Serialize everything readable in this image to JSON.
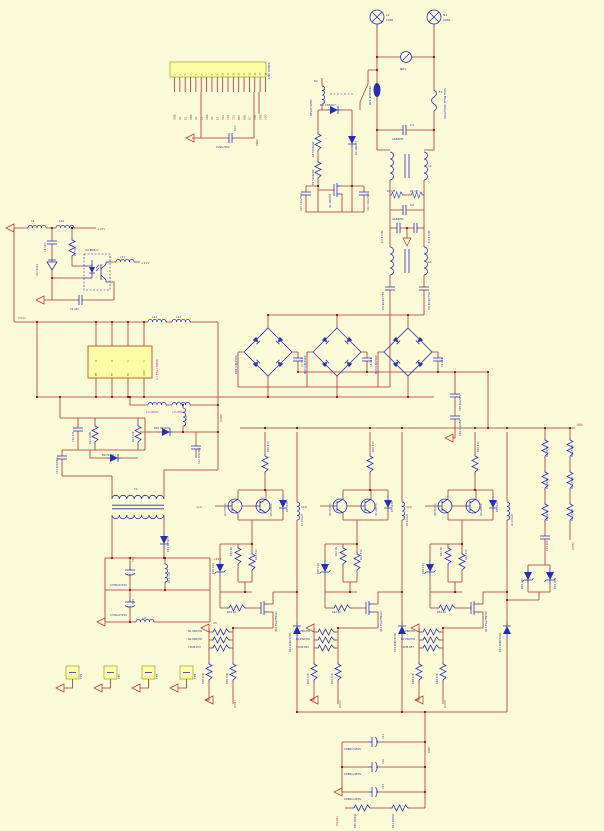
{
  "canvas": {
    "width": 604,
    "height": 831
  },
  "colors": {
    "background": "#fbfbd7",
    "wire": "#b03030",
    "component": "#2b2bb4",
    "junction": "#7d1414",
    "panel_fill": "#ffffa8",
    "panel_stroke": "#a8a832",
    "ic_stroke": "#c24a30",
    "text": {
      "b": "#2b2bb4",
      "r": "#b03030",
      "m": "#bb33bb",
      "k": "#6b6b2a"
    }
  },
  "connector": {
    "ref": "CN1 CON18",
    "pins": [
      "GND",
      "G1",
      "E1",
      "GND",
      "G2",
      "E2",
      "GND",
      "G3",
      "E3",
      "CS1",
      "CS2",
      "CS3",
      "NTC",
      "FAN",
      "SC",
      "VFB",
      "GND",
      "VDD"
    ]
  },
  "ic": {
    "ref": "U1 FSL136MR",
    "pins_top": [
      "D",
      "D",
      "S",
      "S"
    ],
    "pins_bottom": [
      "BP",
      "FB",
      "EN",
      "GND"
    ]
  },
  "testpoints": [
    "TP1",
    "TP2",
    "TP3",
    "TP4"
  ],
  "labels": [
    {
      "t": "C22u/50V",
      "x": 216,
      "y": 148,
      "s": 2.8
    },
    {
      "t": "C17",
      "x": 236,
      "y": 131,
      "r": -90,
      "s": 2.8
    },
    {
      "t": "VDD",
      "x": 258,
      "y": 146,
      "r": -90,
      "c": "r",
      "s": 3
    },
    {
      "t": "L1",
      "x": 386,
      "y": 16,
      "s": 3
    },
    {
      "t": "CON1",
      "x": 386,
      "y": 21,
      "s": 2.6
    },
    {
      "t": "N1",
      "x": 443,
      "y": 16,
      "s": 3
    },
    {
      "t": "CON1",
      "x": 443,
      "y": 21,
      "s": 2.6
    },
    {
      "t": "NE1",
      "x": 400,
      "y": 70,
      "s": 3
    },
    {
      "t": "RV1 10D561K",
      "x": 371,
      "y": 105,
      "r": -90,
      "s": 2.8
    },
    {
      "t": "F1",
      "x": 439,
      "y": 93,
      "s": 3
    },
    {
      "t": "Slow Blow 40A/250V",
      "x": 444,
      "y": 88,
      "r": 90,
      "s": 3
    },
    {
      "t": "K1",
      "x": 314,
      "y": 82,
      "s": 3
    },
    {
      "t": "RELAY-SPDT",
      "x": 312,
      "y": 116,
      "r": -90,
      "s": 2.8
    },
    {
      "t": "C1",
      "x": 410,
      "y": 126,
      "s": 3
    },
    {
      "t": "A682PM",
      "x": 392,
      "y": 140,
      "s": 2.8
    },
    {
      "t": "L2",
      "x": 428,
      "y": 167,
      "s": 3
    },
    {
      "t": "R1 1M",
      "x": 387,
      "y": 192,
      "s": 2.5
    },
    {
      "t": "R2 1M",
      "x": 410,
      "y": 192,
      "s": 2.5
    },
    {
      "t": "C2",
      "x": 410,
      "y": 206,
      "s": 3
    },
    {
      "t": "A682PM",
      "x": 392,
      "y": 220,
      "s": 2.8
    },
    {
      "t": "C3 472M",
      "x": 383,
      "y": 243,
      "r": -90,
      "s": 2.8
    },
    {
      "t": "C4 472M",
      "x": 430,
      "y": 243,
      "r": -90,
      "s": 2.8
    },
    {
      "t": "L3",
      "x": 428,
      "y": 263,
      "s": 3
    },
    {
      "t": "C5 104/275V",
      "x": 384,
      "y": 310,
      "r": -90,
      "s": 2.8
    },
    {
      "t": "C6 104/275V",
      "x": 430,
      "y": 310,
      "r": -90,
      "s": 2.8
    },
    {
      "t": "D1 1N4007",
      "x": 320,
      "y": 106,
      "s": 2.8
    },
    {
      "t": "R5 510K/2W",
      "x": 314,
      "y": 157,
      "r": -90,
      "s": 2.5
    },
    {
      "t": "R6 510K/2W",
      "x": 314,
      "y": 185,
      "r": -90,
      "s": 2.5
    },
    {
      "t": "D2 1N4007",
      "x": 357,
      "y": 155,
      "r": -90,
      "s": 2.5
    },
    {
      "t": "Q1 2N7002",
      "x": 331,
      "y": 208,
      "r": -90,
      "s": 2.5
    },
    {
      "t": "C15 C10u/50V",
      "x": 302,
      "y": 211,
      "r": -90,
      "s": 2.5
    },
    {
      "t": "C16 C10u/50V",
      "x": 369,
      "y": 211,
      "r": -90,
      "s": 2.5
    },
    {
      "t": "BR1 GBJ2510",
      "x": 237,
      "y": 374,
      "r": -90,
      "s": 2.8
    },
    {
      "t": "BR2 GBJ2510",
      "x": 306,
      "y": 374,
      "r": -90,
      "s": 2.8
    },
    {
      "t": "BR3 GBJ2510",
      "x": 377,
      "y": 374,
      "r": -90,
      "s": 2.8
    },
    {
      "t": "C7 471",
      "x": 303,
      "y": 367,
      "r": -90,
      "s": 2.5
    },
    {
      "t": "C8 471",
      "x": 372,
      "y": 367,
      "r": -90,
      "s": 2.5
    },
    {
      "t": "C9 471",
      "x": 443,
      "y": 367,
      "r": -90,
      "s": 2.5
    },
    {
      "t": "C18 102/2KV",
      "x": 461,
      "y": 411,
      "r": -90,
      "s": 2.5
    },
    {
      "t": "C19 102/2KV",
      "x": 461,
      "y": 436,
      "r": -90,
      "s": 2.5
    },
    {
      "t": "VIN",
      "x": 577,
      "y": 426,
      "c": "r",
      "s": 3.2
    },
    {
      "t": "(VDD)",
      "x": 222,
      "y": 422,
      "r": -90,
      "c": "r",
      "s": 2.8
    },
    {
      "t": "(VCC)",
      "x": 18,
      "y": 319,
      "c": "r",
      "s": 2.8
    },
    {
      "t": "R3 510K",
      "x": 548,
      "y": 457,
      "r": -90,
      "s": 2.5
    },
    {
      "t": "R4 510K",
      "x": 548,
      "y": 489,
      "r": -90,
      "s": 2.5
    },
    {
      "t": "R7 510K",
      "x": 548,
      "y": 521,
      "r": -90,
      "s": 2.5
    },
    {
      "t": "C31 104",
      "x": 548,
      "y": 551,
      "r": -90,
      "s": 2.5
    },
    {
      "t": "R15 510K",
      "x": 573,
      "y": 457,
      "r": -90,
      "s": 2.5
    },
    {
      "t": "R16 510K",
      "x": 573,
      "y": 489,
      "r": -90,
      "s": 2.5
    },
    {
      "t": "R17 510K",
      "x": 573,
      "y": 521,
      "r": -90,
      "s": 2.5
    },
    {
      "t": "(VFB)",
      "x": 574,
      "y": 550,
      "r": -90,
      "c": "r",
      "s": 2.8
    },
    {
      "t": "DZ1 30V",
      "x": 523,
      "y": 589,
      "r": -90,
      "s": 2.5
    },
    {
      "t": "DZ2 30V",
      "x": 556,
      "y": 589,
      "r": -90,
      "s": 2.5
    },
    {
      "t": "R30 510",
      "x": 269,
      "y": 452,
      "r": -90,
      "s": 2.5
    },
    {
      "t": "(G1)",
      "x": 196,
      "y": 508,
      "c": "r",
      "s": 2.8
    },
    {
      "t": "Q4 C8050",
      "x": 226,
      "y": 516,
      "r": -90,
      "s": 2.5
    },
    {
      "t": "Q5 A8550",
      "x": 272,
      "y": 516,
      "r": -90,
      "s": 2.5
    },
    {
      "t": "D4 4148",
      "x": 288,
      "y": 512,
      "r": -90,
      "s": 2.5
    },
    {
      "t": "R32 1K",
      "x": 232,
      "y": 556,
      "r": -90,
      "s": 2.5
    },
    {
      "t": "R33 510",
      "x": 257,
      "y": 560,
      "r": -90,
      "s": 2.5
    },
    {
      "t": "DZ4 12V",
      "x": 214,
      "y": 574,
      "r": -90,
      "s": 2.5
    },
    {
      "t": "L4 100uH",
      "x": 303,
      "y": 526,
      "r": -90,
      "s": 2.5
    },
    {
      "t": "R34 10",
      "x": 227,
      "y": 613,
      "s": 2.5
    },
    {
      "t": "Q10 FGA25N120",
      "x": 277,
      "y": 632,
      "r": -90,
      "s": 2.5
    },
    {
      "t": "N1-P80/3W",
      "x": 188,
      "y": 632,
      "s": 2.5
    },
    {
      "t": "N2-P80/3W",
      "x": 188,
      "y": 640,
      "s": 2.5
    },
    {
      "t": "Y1K/B R37",
      "x": 188,
      "y": 648,
      "s": 2.5
    },
    {
      "t": "R38 47K",
      "x": 204,
      "y": 684,
      "r": -90,
      "s": 2.5
    },
    {
      "t": "R39 47K",
      "x": 228,
      "y": 684,
      "r": -90,
      "s": 2.5
    },
    {
      "t": "D12 RHRP3060",
      "x": 291,
      "y": 652,
      "r": -90,
      "s": 2.5
    },
    {
      "t": "(CS1)",
      "x": 236,
      "y": 708,
      "r": -90,
      "c": "r",
      "s": 2.8
    },
    {
      "t": "R40 510",
      "x": 374,
      "y": 452,
      "r": -90,
      "s": 2.5
    },
    {
      "t": "(G2)",
      "x": 301,
      "y": 508,
      "c": "r",
      "s": 2.8
    },
    {
      "t": "Q6 C8050",
      "x": 331,
      "y": 516,
      "r": -90,
      "s": 2.5
    },
    {
      "t": "Q7 A8550",
      "x": 377,
      "y": 516,
      "r": -90,
      "s": 2.5
    },
    {
      "t": "D5 4148",
      "x": 393,
      "y": 512,
      "r": -90,
      "s": 2.5
    },
    {
      "t": "R42 1K",
      "x": 337,
      "y": 556,
      "r": -90,
      "s": 2.5
    },
    {
      "t": "R43 510",
      "x": 362,
      "y": 560,
      "r": -90,
      "s": 2.5
    },
    {
      "t": "DZ5 12V",
      "x": 319,
      "y": 574,
      "r": -90,
      "s": 2.5
    },
    {
      "t": "L5 100uH",
      "x": 408,
      "y": 526,
      "r": -90,
      "s": 2.5
    },
    {
      "t": "R44 10",
      "x": 332,
      "y": 613,
      "s": 2.5
    },
    {
      "t": "Q11 FGA25N120",
      "x": 382,
      "y": 632,
      "r": -90,
      "s": 2.5
    },
    {
      "t": "N1-P80/3W",
      "x": 296,
      "y": 632,
      "s": 2.5
    },
    {
      "t": "N2-P80/3W",
      "x": 296,
      "y": 640,
      "s": 2.5
    },
    {
      "t": "Y1K/B R47",
      "x": 296,
      "y": 648,
      "s": 2.5
    },
    {
      "t": "R48 47K",
      "x": 309,
      "y": 684,
      "r": -90,
      "s": 2.5
    },
    {
      "t": "R49 47K",
      "x": 333,
      "y": 684,
      "r": -90,
      "s": 2.5
    },
    {
      "t": "D13 RHRP3060",
      "x": 396,
      "y": 652,
      "r": -90,
      "s": 2.5
    },
    {
      "t": "(CS2)",
      "x": 341,
      "y": 708,
      "r": -90,
      "c": "r",
      "s": 2.8
    },
    {
      "t": "R50 510",
      "x": 479,
      "y": 452,
      "r": -90,
      "s": 2.5
    },
    {
      "t": "(G3)",
      "x": 406,
      "y": 508,
      "c": "r",
      "s": 2.8
    },
    {
      "t": "Q8 C8050",
      "x": 436,
      "y": 516,
      "r": -90,
      "s": 2.5
    },
    {
      "t": "Q9 A8550",
      "x": 482,
      "y": 516,
      "r": -90,
      "s": 2.5
    },
    {
      "t": "D6 4148",
      "x": 498,
      "y": 512,
      "r": -90,
      "s": 2.5
    },
    {
      "t": "R52 1K",
      "x": 442,
      "y": 556,
      "r": -90,
      "s": 2.5
    },
    {
      "t": "R53 510",
      "x": 467,
      "y": 560,
      "r": -90,
      "s": 2.5
    },
    {
      "t": "DZ6 12V",
      "x": 424,
      "y": 574,
      "r": -90,
      "s": 2.5
    },
    {
      "t": "L6 100uH",
      "x": 513,
      "y": 526,
      "r": -90,
      "s": 2.5
    },
    {
      "t": "R54 10",
      "x": 437,
      "y": 613,
      "s": 2.5
    },
    {
      "t": "Q12 FGA25N120",
      "x": 487,
      "y": 632,
      "r": -90,
      "s": 2.5
    },
    {
      "t": "N1-P80/3W",
      "x": 401,
      "y": 632,
      "s": 2.5
    },
    {
      "t": "N2-P80/3W",
      "x": 401,
      "y": 640,
      "s": 2.5
    },
    {
      "t": "Y1K/B R57",
      "x": 401,
      "y": 648,
      "s": 2.5
    },
    {
      "t": "R58 47K",
      "x": 414,
      "y": 684,
      "r": -90,
      "s": 2.5
    },
    {
      "t": "R59 47K",
      "x": 438,
      "y": 684,
      "r": -90,
      "s": 2.5
    },
    {
      "t": "D14 RHRP3060",
      "x": 501,
      "y": 652,
      "r": -90,
      "s": 2.5
    },
    {
      "t": "(CS3)",
      "x": 446,
      "y": 708,
      "r": -90,
      "c": "r",
      "s": 2.8
    },
    {
      "t": "L9",
      "x": 31,
      "y": 222,
      "s": 2.8
    },
    {
      "t": "L10",
      "x": 59,
      "y": 222,
      "s": 2.8
    },
    {
      "t": "+15V",
      "x": 97,
      "y": 230,
      "c": "r",
      "s": 3
    },
    {
      "t": "C8 104",
      "x": 46,
      "y": 252,
      "r": -90,
      "s": 2.5
    },
    {
      "t": "R9 51K",
      "x": 76,
      "y": 256,
      "r": -90,
      "s": 2.5
    },
    {
      "t": "U3 TL431",
      "x": 38,
      "y": 276,
      "r": -90,
      "s": 2.5
    },
    {
      "t": "U2 PC817",
      "x": 85,
      "y": 251,
      "s": 2.8
    },
    {
      "t": "L11",
      "x": 120,
      "y": 258,
      "s": 2.8
    },
    {
      "t": "+12V",
      "x": 141,
      "y": 264,
      "c": "r",
      "s": 3
    },
    {
      "t": "C9 222",
      "x": 70,
      "y": 310,
      "s": 2.5
    },
    {
      "t": "L12",
      "x": 152,
      "y": 318,
      "s": 2.8
    },
    {
      "t": "L13",
      "x": 176,
      "y": 318,
      "s": 2.8
    },
    {
      "t": "L14 BEAD",
      "x": 146,
      "y": 413,
      "c": "m",
      "s": 2.5
    },
    {
      "t": "L15 BEAD",
      "x": 172,
      "y": 413,
      "c": "m",
      "s": 2.5
    },
    {
      "t": "U1 FSL136MR",
      "x": 158,
      "y": 380,
      "r": -90,
      "c": "m",
      "s": 3
    },
    {
      "t": "C10 471",
      "x": 74,
      "y": 442,
      "r": -90,
      "s": 2.5
    },
    {
      "t": "R12 100K",
      "x": 91,
      "y": 444,
      "r": -90,
      "s": 2.5
    },
    {
      "t": "R13 47K",
      "x": 134,
      "y": 442,
      "r": -90,
      "s": 2.5
    },
    {
      "t": "D9 FR107",
      "x": 102,
      "y": 456,
      "s": 2.5
    },
    {
      "t": "C11 222/2KV",
      "x": 58,
      "y": 474,
      "r": -90,
      "s": 2.5
    },
    {
      "t": "D10 SR5100",
      "x": 154,
      "y": 429,
      "s": 2.5
    },
    {
      "t": "L16",
      "x": 187,
      "y": 420,
      "r": -90,
      "s": 2.5
    },
    {
      "t": "C12 222/1KV",
      "x": 200,
      "y": 464,
      "r": -90,
      "s": 2.5
    },
    {
      "t": "T1",
      "x": 134,
      "y": 490,
      "s": 3
    },
    {
      "t": "D11 SB5100",
      "x": 169,
      "y": 552,
      "r": -90,
      "s": 2.5
    },
    {
      "t": "C13",
      "x": 134,
      "y": 562,
      "r": -90,
      "s": 2.5
    },
    {
      "t": "C330uF/25V",
      "x": 110,
      "y": 586,
      "s": 2.8
    },
    {
      "t": "C14",
      "x": 134,
      "y": 604,
      "r": -90,
      "s": 2.5
    },
    {
      "t": "C330uF/25V",
      "x": 110,
      "y": 616,
      "s": 2.8
    },
    {
      "t": "L8 4.7uH",
      "x": 170,
      "y": 583,
      "r": -90,
      "s": 2.5
    },
    {
      "t": "L17",
      "x": 142,
      "y": 619,
      "s": 2.5
    },
    {
      "t": "+24V",
      "x": 213,
      "y": 560,
      "c": "r",
      "s": 3
    },
    {
      "t": "0V",
      "x": 213,
      "y": 624,
      "c": "r",
      "s": 3
    },
    {
      "t": "C680u/450V",
      "x": 344,
      "y": 750,
      "s": 2.8
    },
    {
      "t": "C21",
      "x": 384,
      "y": 739,
      "r": -90,
      "s": 2.5
    },
    {
      "t": "C680u/450V",
      "x": 344,
      "y": 775,
      "s": 2.8
    },
    {
      "t": "C22",
      "x": 384,
      "y": 764,
      "r": -90,
      "s": 2.5
    },
    {
      "t": "C680u/450V",
      "x": 344,
      "y": 800,
      "s": 2.8
    },
    {
      "t": "C23",
      "x": 384,
      "y": 789,
      "r": -90,
      "s": 2.5
    },
    {
      "t": "GND",
      "x": 430,
      "y": 753,
      "r": -90,
      "c": "r",
      "s": 2.8
    },
    {
      "t": "(VAUX)",
      "x": 338,
      "y": 826,
      "r": -90,
      "c": "r",
      "s": 2.8
    },
    {
      "t": "R66 1K/2W",
      "x": 356,
      "y": 828,
      "r": -90,
      "s": 2.5
    },
    {
      "t": "R67 1K/2W",
      "x": 394,
      "y": 828,
      "r": -90,
      "s": 2.5
    },
    {
      "t": "CN1 CON18",
      "x": 270,
      "y": 79,
      "r": -90,
      "s": 2.8
    }
  ]
}
